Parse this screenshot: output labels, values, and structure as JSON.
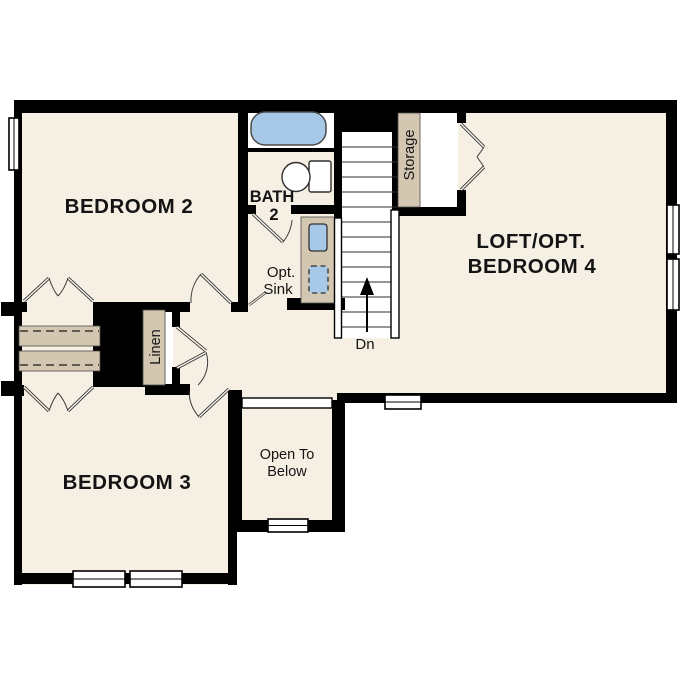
{
  "colors": {
    "background": "#ffffff",
    "floor": "#f6efe4",
    "wall": "#000000",
    "cabinet_tan": "#d3c7b2",
    "fixture_blue": "#a8c8e8",
    "white": "#ffffff"
  },
  "rooms": {
    "bedroom2": {
      "label": "BEDROOM 2"
    },
    "bath2": {
      "line1": "BATH",
      "line2": "2"
    },
    "loft": {
      "line1": "LOFT/OPT.",
      "line2": "BEDROOM 4"
    },
    "bedroom3": {
      "label": "BEDROOM 3"
    },
    "open_to_below": {
      "line1": "Open To",
      "line2": "Below"
    }
  },
  "annotations": {
    "opt_sink": {
      "line1": "Opt.",
      "line2": "Sink"
    },
    "storage": "Storage",
    "linen": "Linen",
    "stair_direction": "Dn"
  }
}
